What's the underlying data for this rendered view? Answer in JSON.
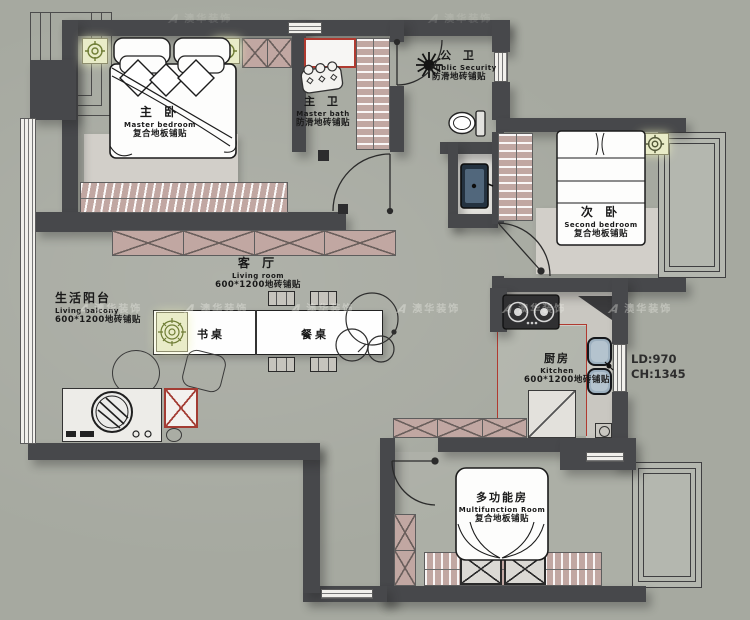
{
  "watermark": {
    "logo_letter": "A",
    "brand": "澳华装饰"
  },
  "rooms": {
    "master_bedroom": {
      "cn": "主 卧",
      "en": "Master bedroom",
      "floor": "复合地板铺贴"
    },
    "master_bath": {
      "cn": "主 卫",
      "en": "Master bath",
      "floor": "防滑地砖铺贴"
    },
    "public_bath": {
      "cn": "公 卫",
      "en": "Public Security",
      "floor": "防滑地砖铺贴"
    },
    "second_bedroom": {
      "cn": "次 卧",
      "en": "Second bedroom",
      "floor": "复合地板铺贴"
    },
    "living_room": {
      "cn": "客 厅",
      "en": "Living room",
      "floor": "600*1200地砖铺贴"
    },
    "living_balcony": {
      "cn": "生活阳台",
      "en": "Living balcony",
      "floor": "600*1200地砖铺贴"
    },
    "kitchen": {
      "cn": "厨房",
      "en": "Kitchen",
      "floor": "600*1200地砖铺贴"
    },
    "multifunction_room": {
      "cn": "多功能房",
      "en": "Multifunction Room",
      "floor": "复合地板铺贴"
    }
  },
  "furniture_labels": {
    "desk": "书桌",
    "dining_table": "餐桌"
  },
  "dimensions": {
    "ld": "LD:970",
    "ch": "CH:1345"
  },
  "colors": {
    "wall": "#47484b",
    "cabinet_pink": "#c1a7a2",
    "accent_red": "#b03a30",
    "light_fixture": "#6f7d35",
    "background": "#a6a9a0"
  }
}
